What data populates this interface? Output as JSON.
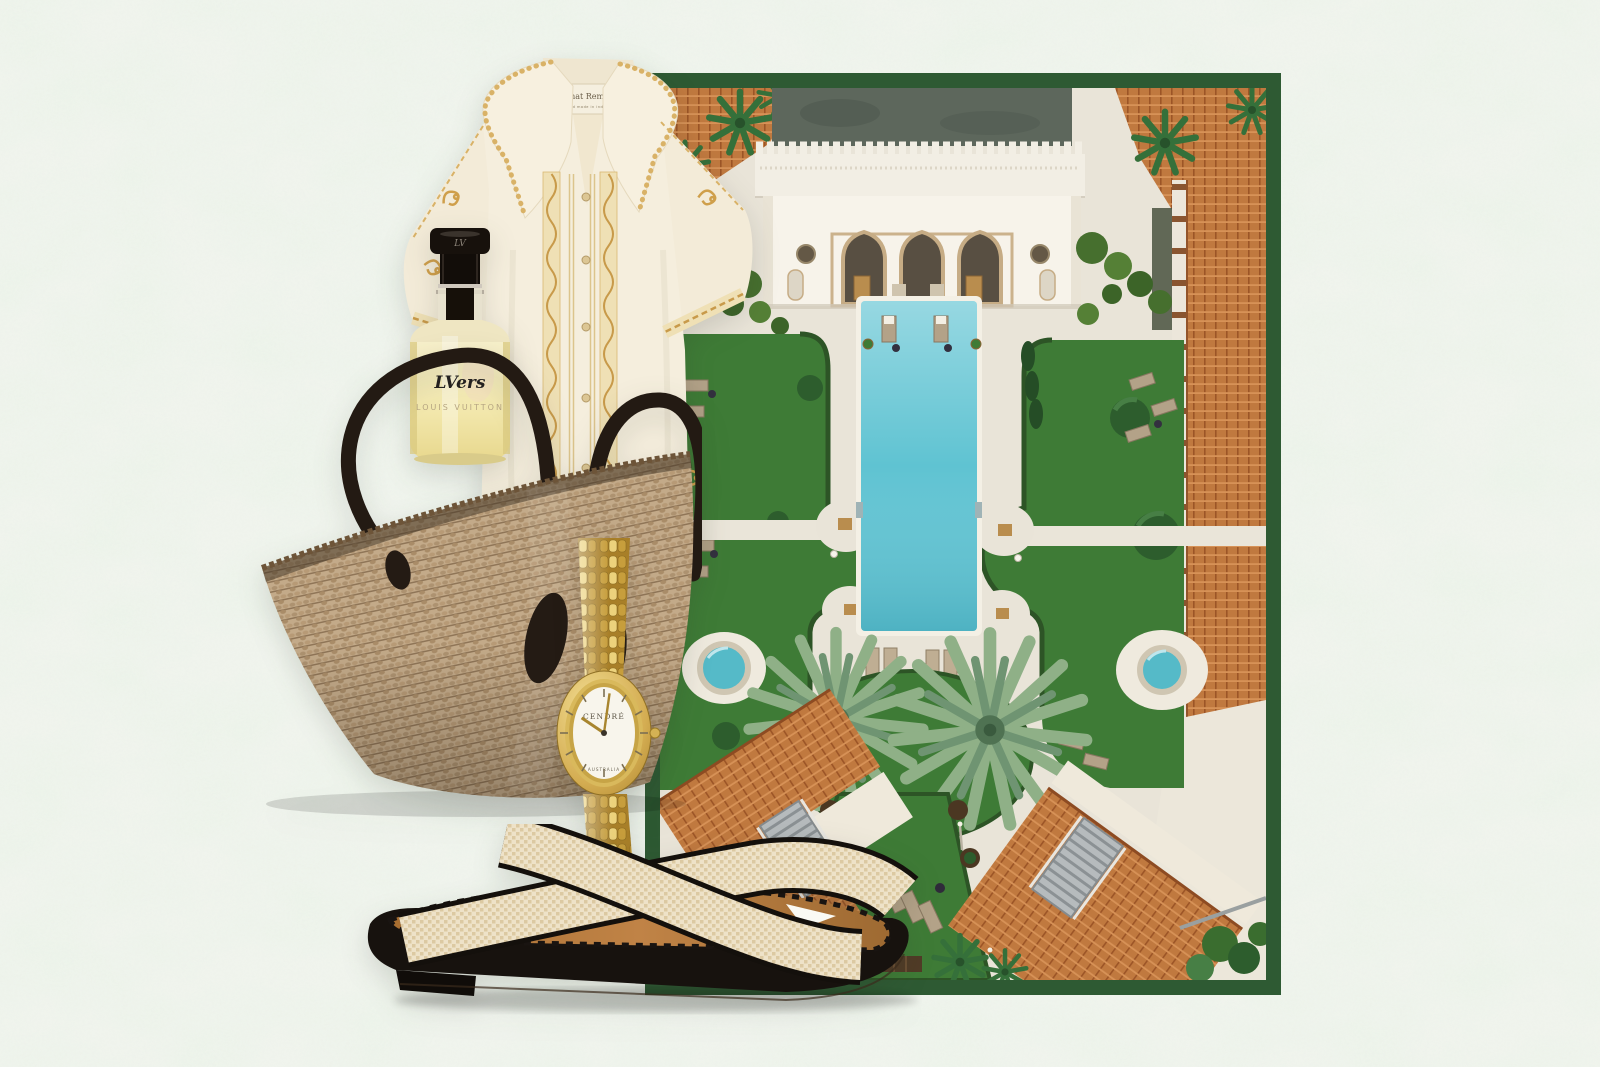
{
  "background": {
    "paper_color": "#eff3ec",
    "mottle_color": "#cfe3cb"
  },
  "collage": {
    "resort_photo": {
      "frame_color": "#2e5a33",
      "description": "Aerial view of a Moorish-style resort courtyard with rectangular pool, lawns, loungers, twin round spas, fan palms and terracotta rooftops",
      "pool_color": "#5fc3d2",
      "lawn_color": "#3e7b36",
      "tile_roof_color": "#c0793f",
      "building_color": "#f7f3ea"
    },
    "shirt": {
      "label_title": "All That Remains",
      "label_subtitle": "hand made in india",
      "body_color": "#f5eedd",
      "embroidery_color": "#cf9f4b"
    },
    "perfume": {
      "cap_monogram": "LV",
      "label_script": "LVers",
      "label_brand": "LOUIS VUITTON",
      "liquid_color": "#f2e7ab"
    },
    "tote_bag": {
      "material": "woven straw",
      "straw_color": "#c3aa89",
      "handle_color": "#231a13"
    },
    "watch": {
      "brand": "CENDRÉ",
      "origin_label": "AUSTRALIA",
      "time": "10:01",
      "gold_color": "#d4ad52",
      "dial_color": "#f8f5ec"
    },
    "sandal": {
      "style": "crossover woven slide",
      "strap_color": "#eee2c8",
      "insole_color": "#b0783c",
      "sole_color": "#17120e"
    }
  }
}
